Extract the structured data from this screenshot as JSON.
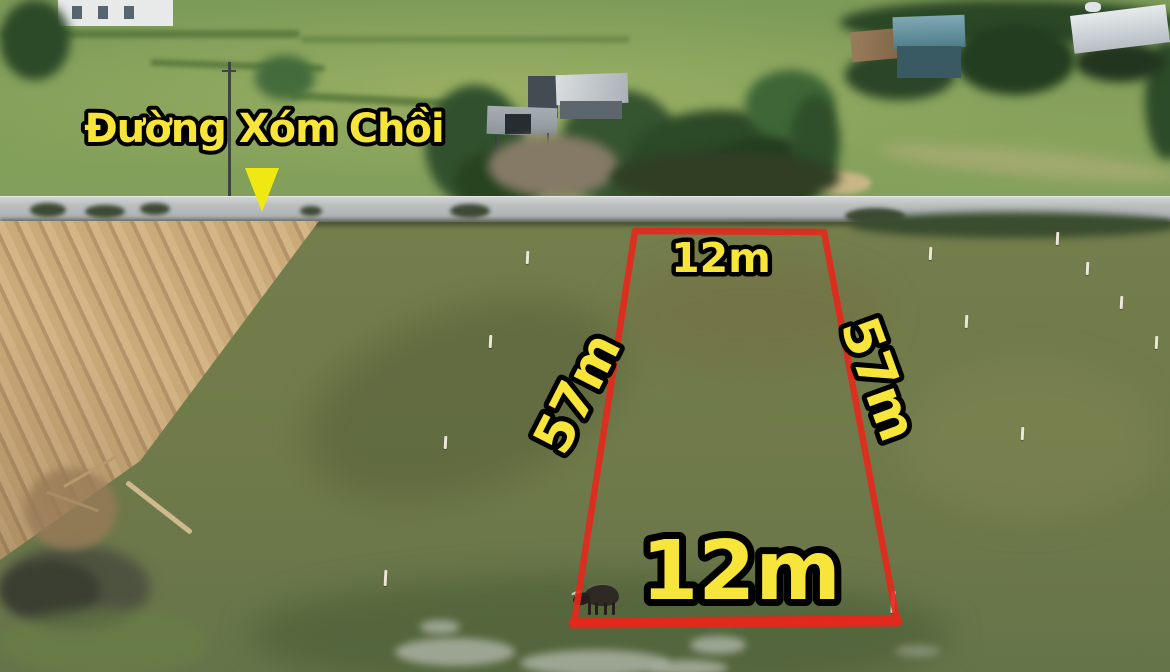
{
  "labels": {
    "road_name": "Đường Xóm Chồi",
    "plot_top_width": "12m",
    "plot_left_length": "57m",
    "plot_right_length": "57m",
    "plot_bottom_width": "12m"
  },
  "marker": {
    "shape": "triangle-down"
  },
  "colors": {
    "plot_outline": "#e4281c",
    "label_fill": "#f8e53a",
    "label_stroke": "#000000",
    "marker_fill": "#f0e812"
  }
}
